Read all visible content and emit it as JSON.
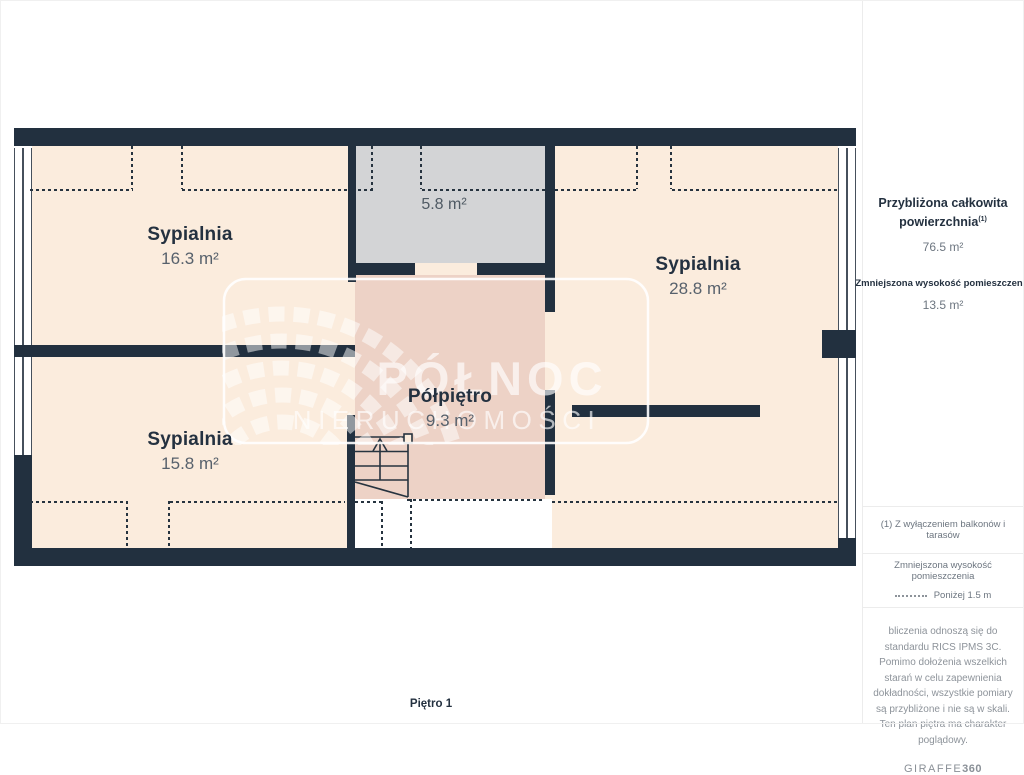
{
  "plan": {
    "floor_label": "Piętro 1",
    "rooms": [
      {
        "name": "Sypialnia",
        "area": "16.3 m²"
      },
      {
        "name": "Sypialnia",
        "area": "28.8 m²"
      },
      {
        "name": "Sypialnia",
        "area": "15.8 m²"
      },
      {
        "name": "Półpiętro",
        "area": "9.3 m²"
      },
      {
        "name": "",
        "area": "5.8 m²"
      }
    ],
    "watermark": {
      "line1": "PÓŁNOC",
      "line2": "NIERUCHOMOŚCI"
    }
  },
  "sidebar": {
    "total_area_label": "Przybliżona całkowita powierzchnia",
    "total_area_sup": "(1)",
    "total_area_value": "76.5 m²",
    "reduced_height_label": "Zmniejszona wysokość pomieszczenia",
    "reduced_height_value": "13.5 m²",
    "footnote": "(1) Z wyłączeniem balkonów i tarasów",
    "legend_title": "Zmniejszona wysokość pomieszczenia",
    "legend_value": "Poniżej 1.5 m",
    "disclaimer": "bliczenia odnoszą się do standardu RICS IPMS 3C. Pomimo dołożenia wszelkich starań w celu zapewnienia dokładności, wszystkie pomiary są przybliżone i nie są w skali. Ten plan piętra ma charakter poglądowy.",
    "brand_name": "GIRAFFE",
    "brand_number": "360"
  },
  "colors": {
    "wall": "#22303f",
    "floor": "#fbecdd",
    "reduced_height_floor": "#edd2c6",
    "low_area_floor": "#d3d4d6",
    "text_dark": "#243140",
    "text_gray": "#6d7680"
  }
}
